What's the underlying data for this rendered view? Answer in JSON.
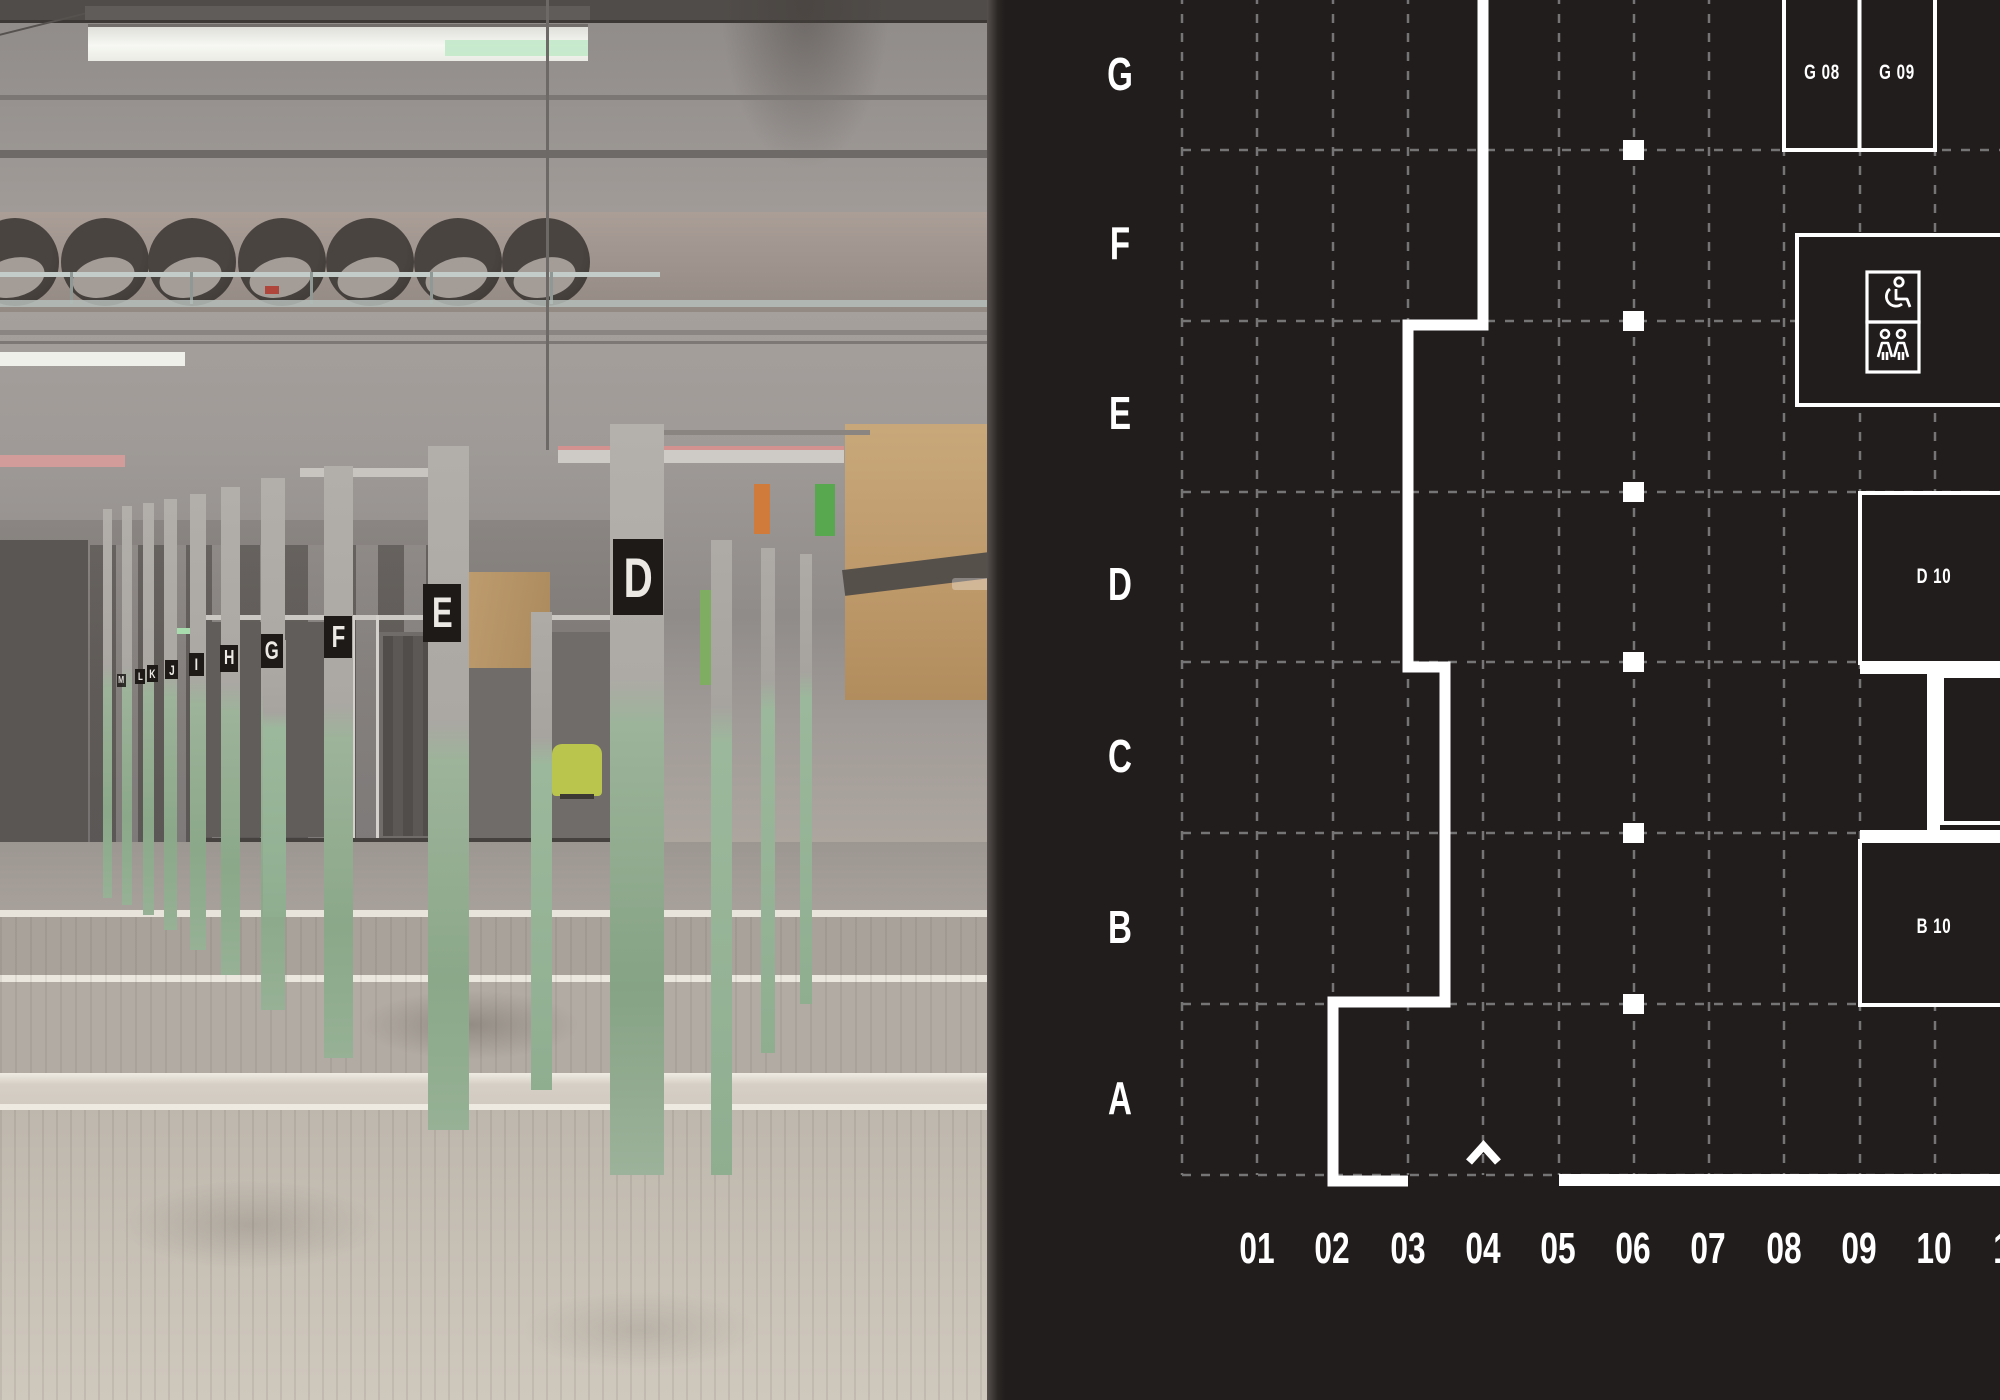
{
  "colors": {
    "plan_bg": "#211d1c",
    "grid_dash": "#757575",
    "line_white": "#ffffff",
    "plate_black": "#1d1a18",
    "column_green": "#96b195",
    "chair_green": "#b9c54d",
    "plywood_tan": "#bd9869"
  },
  "photo": {
    "plates": [
      {
        "label": "D"
      },
      {
        "label": "E"
      },
      {
        "label": "F"
      },
      {
        "label": "G"
      },
      {
        "label": "H"
      },
      {
        "label": "I"
      },
      {
        "label": "J"
      },
      {
        "label": "K"
      },
      {
        "label": "L"
      },
      {
        "label": "M"
      }
    ]
  },
  "plan": {
    "rows": [
      "G",
      "F",
      "E",
      "D",
      "C",
      "B",
      "A"
    ],
    "columns": [
      "01",
      "02",
      "03",
      "04",
      "05",
      "06",
      "07",
      "08",
      "09",
      "10",
      "11"
    ],
    "rooms": {
      "g08": "G 08",
      "g09": "G 09",
      "d10": "D 10",
      "b10": "B 10"
    },
    "legend_icons": [
      "wheelchair-icon",
      "family-changing-icon"
    ],
    "entrance_marker": "chevron-up"
  }
}
